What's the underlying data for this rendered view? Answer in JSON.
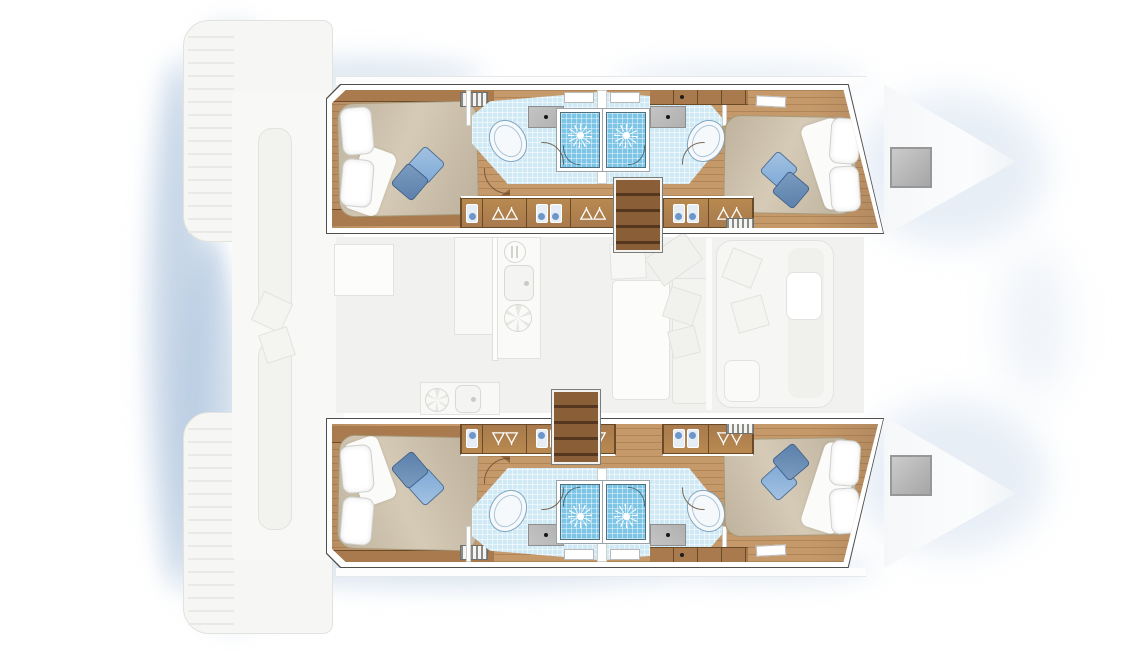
{
  "document": {
    "kind": "floor-plan",
    "subject": "catamaran 4-cabin interior layout, top-down view",
    "rendering": "hull interiors shown in full colour; salon, cockpit and bows shown faded grey",
    "orientation": {
      "bow": "right",
      "stern": "left"
    },
    "canvas": {
      "width": 1140,
      "height": 652
    }
  },
  "colors": {
    "background": "#ffffff",
    "wood_floor": "#c6996a",
    "wood_plank_line": "rgba(124,86,48,.30)",
    "wood_trim": "#a87a4e",
    "wood_trim_dark": "#6b4a28",
    "wood_wedge": "#916539",
    "stairs_wood": "#7a5130",
    "mattress": "#cfc2ab",
    "duvet_white": "#fbfbfa",
    "pillow_white": "#ffffff",
    "cushion_light_blue": "#7ea9d6",
    "cushion_dark_blue": "#5b80ab",
    "shower_tile": "#7cc5e6",
    "bathroom_tile": "#cfe9f5",
    "fixture_white": "#f6f9fb",
    "fixture_outline": "#7fa6c2",
    "vanity_grey": "#b0b0b0",
    "hull_wall_white": "#ffffff",
    "hull_outline": "#4f4f4d",
    "faded_fill": "#f6f6f4",
    "faded_stroke": "#e2e2de",
    "salon_floor": "#f1f1ef",
    "shadow_blue": "#aac1de",
    "deck_hatch_grey": "#979797"
  },
  "hulls": [
    {
      "id": "upper-hull",
      "rooms": [
        {
          "name": "aft-cabin",
          "furniture": [
            "double-bed",
            "white-pillow",
            "white-pillow",
            "blue-cushion-light",
            "blue-cushion-dark",
            "duvet-fold",
            "headboard-shelf",
            "foot-shelf",
            "louver-vent"
          ]
        },
        {
          "name": "aft-bathroom",
          "fixtures": [
            "washbasin-vanity",
            "toilet",
            "shower-stall",
            "hull-window"
          ]
        },
        {
          "name": "forward-bathroom",
          "fixtures": [
            "washbasin-vanity",
            "toilet",
            "shower-stall",
            "hull-window"
          ]
        },
        {
          "name": "forward-cabin",
          "furniture": [
            "double-bed",
            "white-pillow",
            "white-pillow",
            "blue-cushion-light",
            "blue-cushion-dark",
            "duvet-fold",
            "wardrobe-shelf",
            "step-bench",
            "louver-vent"
          ]
        }
      ],
      "storage_row": [
        "linen-locker",
        "hanging-locker",
        "linen-locker",
        "hanging-locker",
        "linen-locker",
        "hanging-locker"
      ],
      "access": "companionway-stairs"
    },
    {
      "id": "lower-hull",
      "rooms": [
        {
          "name": "aft-cabin",
          "furniture": [
            "double-bed",
            "white-pillow",
            "white-pillow",
            "blue-cushion-light",
            "blue-cushion-dark",
            "duvet-fold",
            "headboard-shelf",
            "foot-shelf",
            "louver-vent"
          ]
        },
        {
          "name": "aft-bathroom",
          "fixtures": [
            "washbasin-vanity",
            "toilet",
            "shower-stall",
            "hull-window"
          ]
        },
        {
          "name": "forward-bathroom",
          "fixtures": [
            "washbasin-vanity",
            "toilet",
            "shower-stall",
            "hull-window"
          ]
        },
        {
          "name": "forward-cabin",
          "furniture": [
            "double-bed",
            "white-pillow",
            "white-pillow",
            "blue-cushion-light",
            "blue-cushion-dark",
            "duvet-fold",
            "wardrobe-shelf",
            "step-bench",
            "louver-vent"
          ]
        }
      ],
      "storage_row": [
        "linen-locker",
        "hanging-locker",
        "linen-locker",
        "hanging-locker",
        "linen-locker",
        "hanging-locker"
      ],
      "access": "companionway-stairs"
    }
  ],
  "salon": {
    "state": "faded",
    "items": [
      "galley-counter",
      "cutlery-drawer",
      "galley-sink",
      "stove-burner",
      "aft-galley-counter",
      "aft-galley-sink",
      "aft-galley-burner",
      "nav-seat",
      "dinette-end-seat",
      "dinette-table",
      "dinette-bench",
      "seat-cushions",
      "divider",
      "sofa",
      "sofa-backrest",
      "side-table",
      "stool",
      "lounge-chair"
    ]
  },
  "cockpit": {
    "state": "faded",
    "items": [
      "port-transom-steps",
      "starboard-transom-steps",
      "cockpit-floor",
      "bench-seat",
      "bench-seat",
      "bench-cushions"
    ]
  },
  "foredeck": {
    "state": "faded",
    "items": [
      "port-bow",
      "starboard-bow",
      "port-deck-hatch",
      "starboard-deck-hatch"
    ]
  },
  "icons": {
    "shower-drain-icon": "white sunburst on blue tile",
    "hanger-icon": "white clothes hangers in locker",
    "sink-drain-icon": "black dot on grey vanity",
    "stove-burner-icon": "spoked circle",
    "cutlery-icon": "fork and knife in circle",
    "door-swing-icon": "quarter-circle arc"
  }
}
